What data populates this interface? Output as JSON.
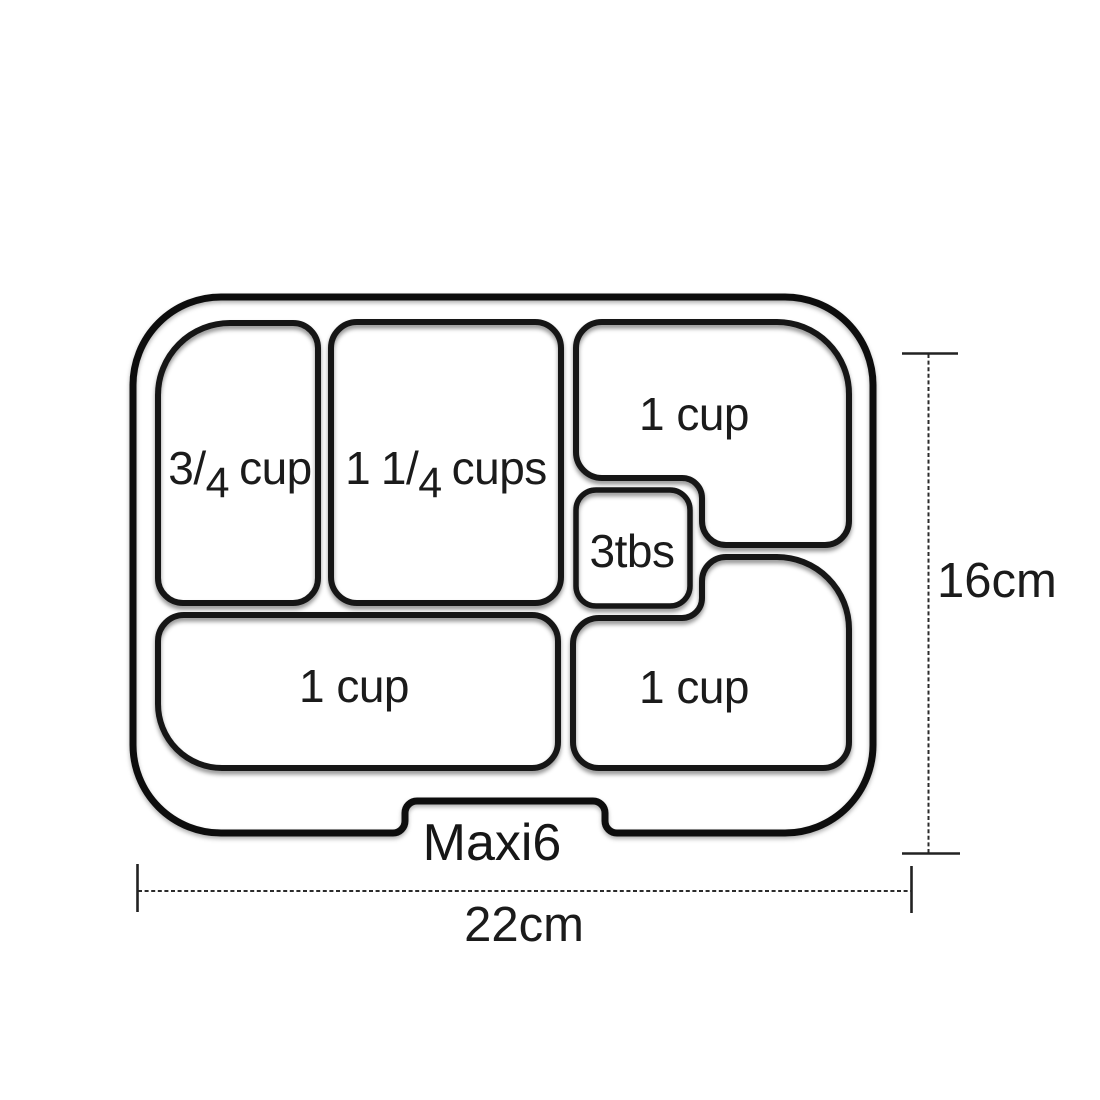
{
  "figure": {
    "model_label": "Maxi6",
    "dimensions": {
      "height_label": "16cm",
      "width_label": "22cm"
    },
    "compartments": {
      "top_left": {
        "label": "3/4 cup",
        "num": "3",
        "slash": "/",
        "den": "4",
        "unit": "cup"
      },
      "top_middle": {
        "label": "1 1/4 cups",
        "whole": "1",
        "num": "1",
        "slash": "/",
        "den": "4",
        "unit": "cups"
      },
      "top_right": {
        "label": "1 cup"
      },
      "center_small": {
        "label": "3tbs"
      },
      "bottom_left": {
        "label": "1 cup"
      },
      "bottom_right": {
        "label": "1 cup"
      }
    },
    "colors": {
      "line": "#161616",
      "text": "#1b1b1b",
      "background": "#ffffff"
    }
  }
}
